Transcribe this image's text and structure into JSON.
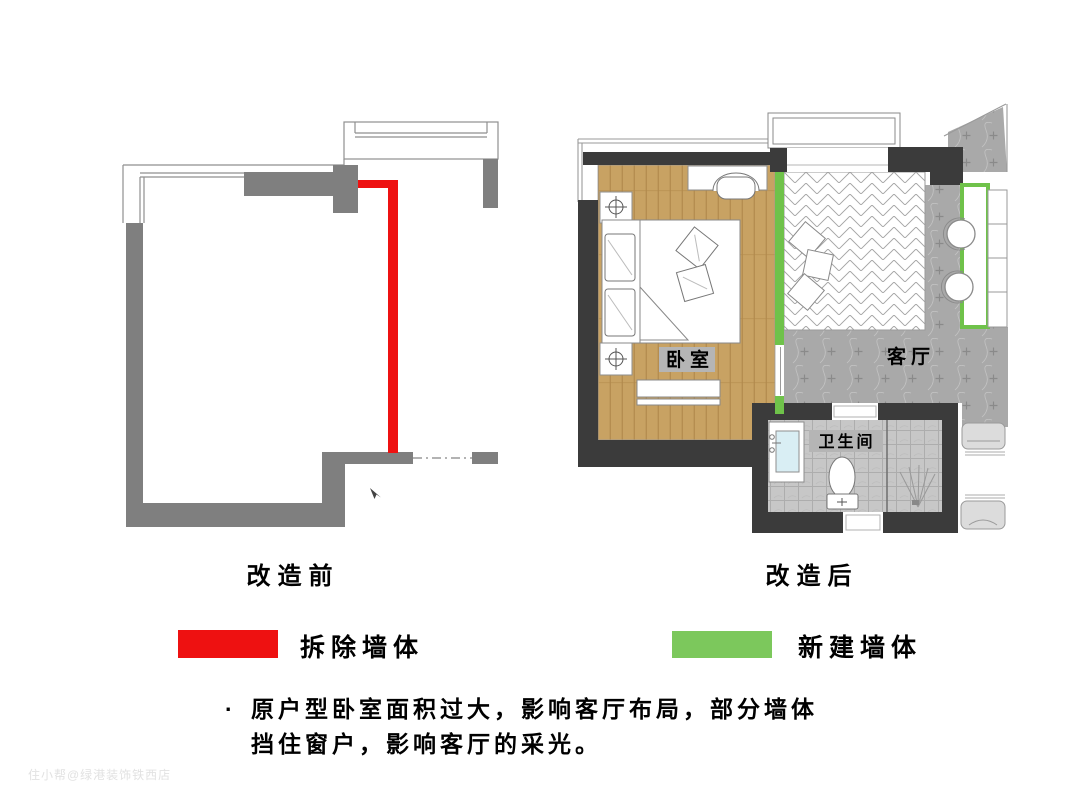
{
  "titles": {
    "before": "改造前",
    "after": "改造后"
  },
  "room_labels": {
    "bedroom": "卧室",
    "living_room": "客厅",
    "bathroom": "卫生间"
  },
  "legend": {
    "demolish": {
      "label": "拆除墙体",
      "color": "#ee1111"
    },
    "new_wall": {
      "label": "新建墙体",
      "color": "#7cc85c"
    }
  },
  "notes": {
    "bullet": "·",
    "line1": "原户型卧室面积过大，影响客厅布局，部分墙体",
    "line2": "挡住窗户，影响客厅的采光。"
  },
  "watermark": "住小帮@绿港装饰铁西店",
  "colors": {
    "demolish_red": "#ee1111",
    "new_wall_green": "#6fc24a",
    "wall_gray": "#7f7f7f",
    "wall_dark": "#3b3b3b",
    "label_bg": "#b5b5b5",
    "wood_floor": "#c8a263",
    "marble_floor": "#a9a9a9"
  }
}
